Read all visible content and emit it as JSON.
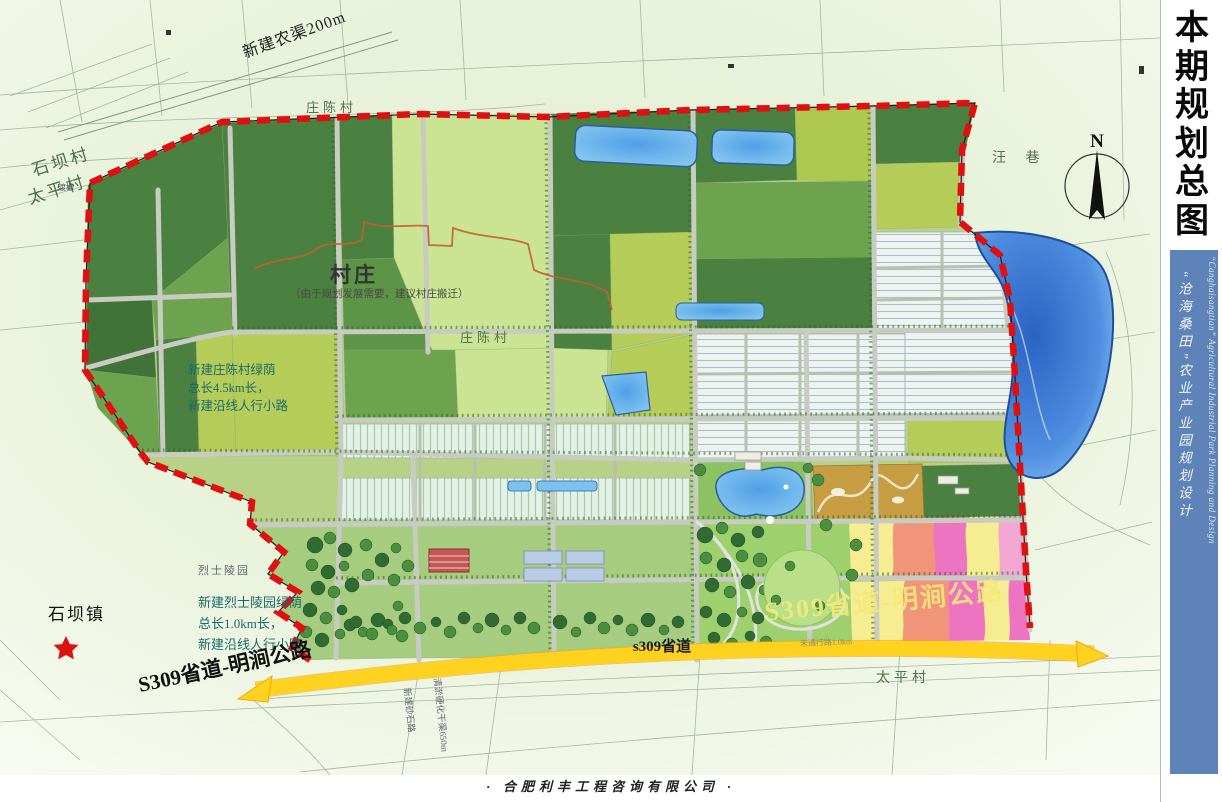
{
  "page": {
    "footer": "·  合肥利丰工程咨询有限公司  ·"
  },
  "sidebar": {
    "title_chars": [
      "本",
      "期",
      "规",
      "划",
      "总",
      "图"
    ],
    "subtitle_cn": "“沧海桑田”农业产业园规划设计",
    "subtitle_en": "“Canghaisangtian” Agricultural Industrial Park Planning and Design",
    "panel_color": "#5d83b8"
  },
  "map": {
    "compass_label": "N",
    "villages": {
      "shiba_village": "石坝村",
      "taiping_west": "太平村",
      "zhuangchen_top": "庄陈村",
      "zhuangchen_mid": "庄陈村",
      "wangxiang": "汪 巷",
      "taiping_south": "太平村",
      "shiba_town": "石坝镇"
    },
    "annotations": {
      "new_canal": "新建农渠200m",
      "aqueduct": "渡槽",
      "village_title": "村庄",
      "village_note": "（由于规划发展需要，建议村庄搬迁）",
      "mid_green_note": [
        "新建庄陈村绿荫",
        "总长4.5km长，",
        "新建沿线人行小路"
      ],
      "martyr_cemetery": "烈士陵园",
      "sw_green_note": [
        "新建烈士陵园绿荫",
        "总长1.0km长，",
        "新建沿线人行小路"
      ],
      "road_note_small": "未通行路1.0km",
      "new_gravel_road": "新建砂石路",
      "canal_hardening": "清淤硬化干渠650m"
    },
    "roads": {
      "s309_sw": "S309省道-明涧公路",
      "s309_center": "s309省道",
      "s309_faded": "S309省道-明涧公路"
    },
    "colors": {
      "boundary": "#dd1111",
      "highway": "#ffd21f",
      "water": "#63b2ee",
      "lake_deep": "#2b63c4",
      "field_dark": "#4a8040",
      "field_mid": "#6da34f",
      "field_yellow": "#b6cc58",
      "field_pale": "#cbe493",
      "greenhouse": "#e6f4e9",
      "zone_pink": "#ee74c2",
      "zone_salmon": "#f1957a",
      "zone_yellow": "#f6ec92",
      "orchard_tan": "#c79d42"
    }
  }
}
